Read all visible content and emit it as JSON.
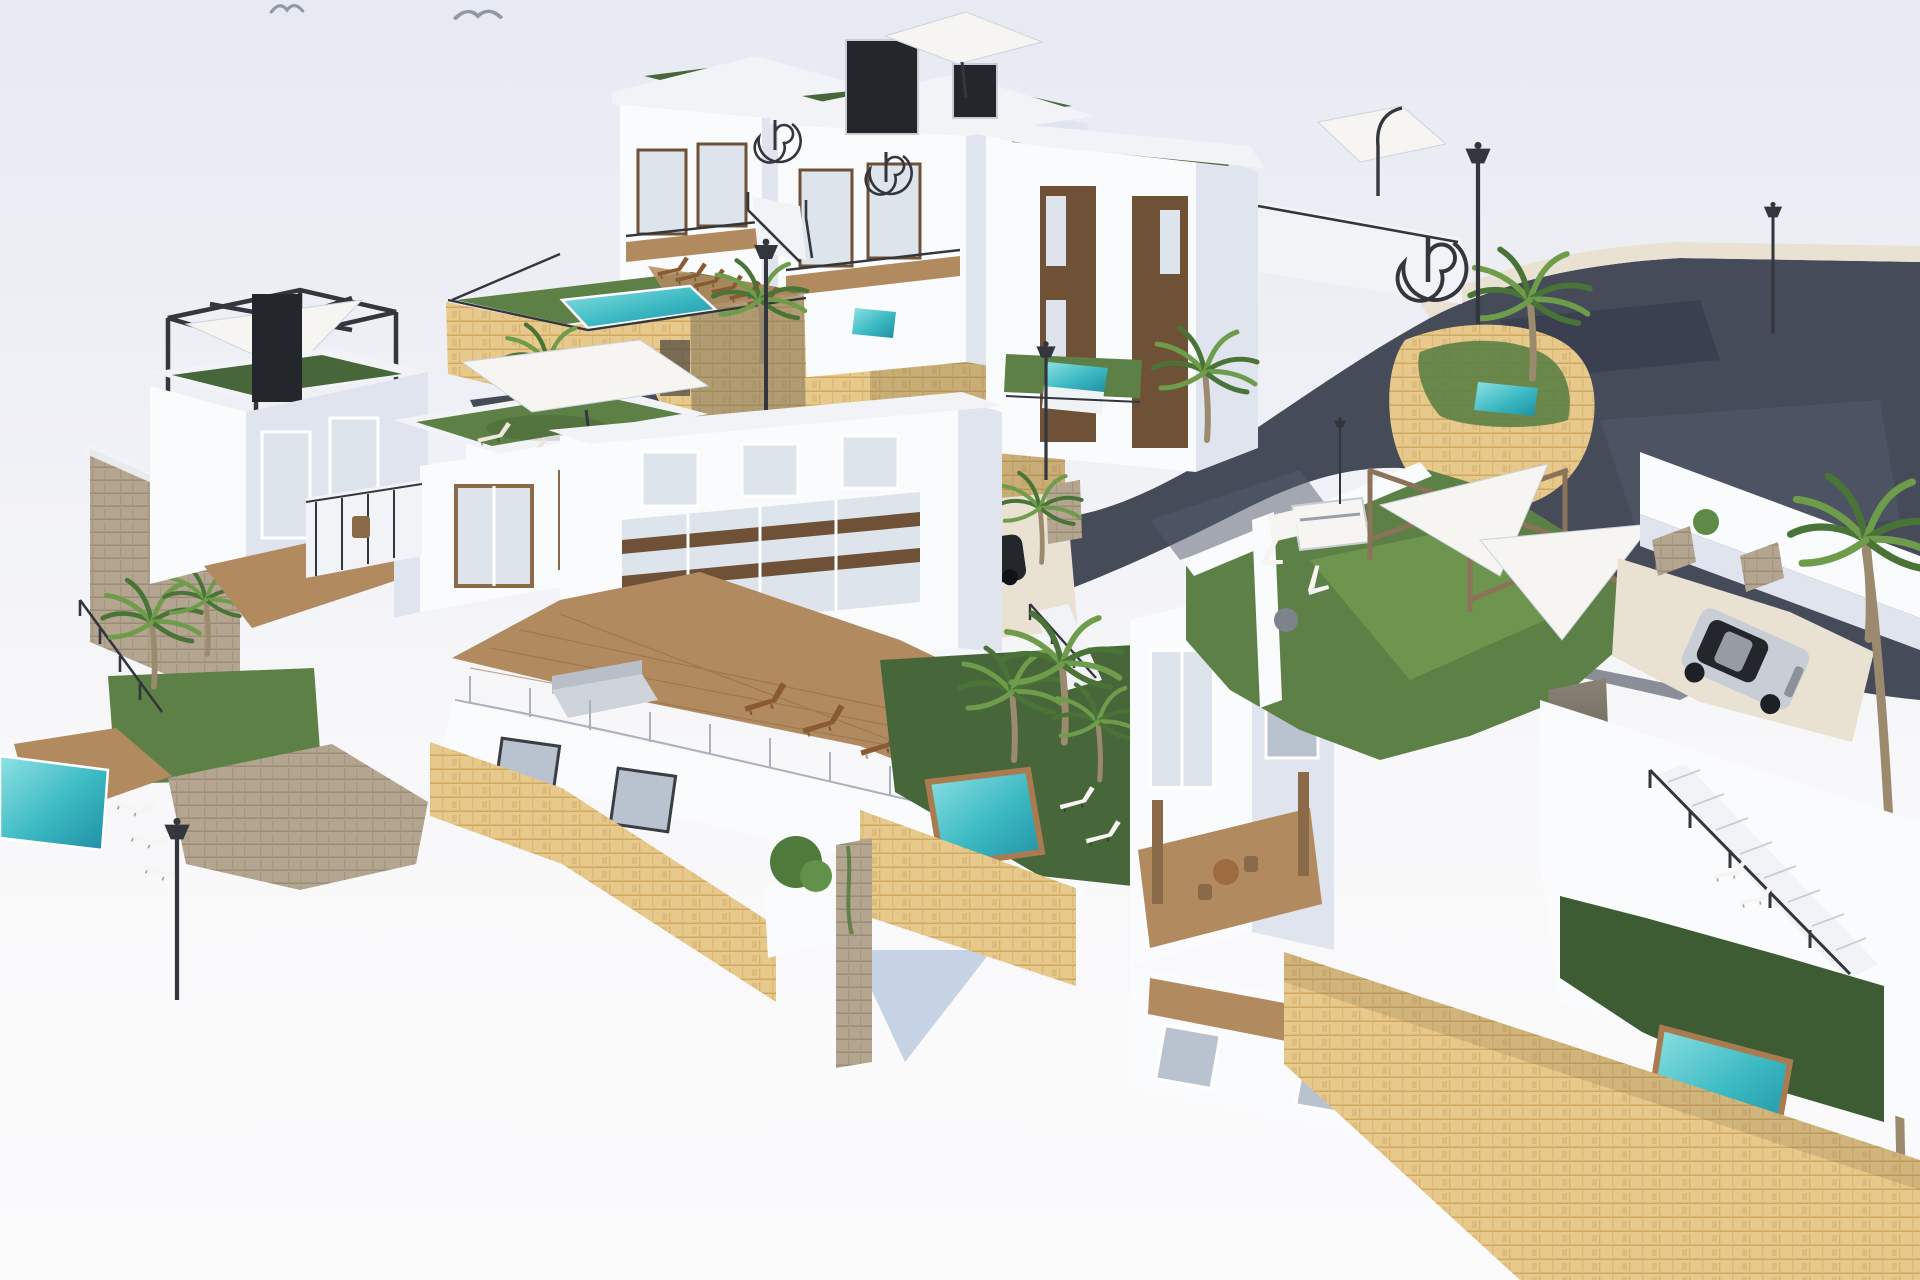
{
  "scene": {
    "type": "3d-architectural-render",
    "view": "aerial-isometric",
    "description": "Aerial 3D architectural rendering of a modern hillside villa development: white multi-storey villas with rooftop lawns and wooden deck terraces, turquoise plunge pools, sandstone retaining walls, palm trees, black street lamps, shade-sail pergolas, spiral staircases, and a curved dark asphalt road with parked cars. Two seagulls fly in the pale sky.",
    "counts": {
      "villas": 9,
      "pools": 7,
      "palm_trees": 10,
      "street_lamps": 6,
      "cars": 5,
      "birds": 2,
      "parasols": 3,
      "shade_sails": 3,
      "spiral_staircases": 4,
      "sun_loungers": 21
    }
  },
  "objects": {
    "cars": [
      {
        "name": "red-hatchback",
        "color": "#d8353f",
        "location": "asphalt road, upper right"
      },
      {
        "name": "dark-red-suv",
        "color": "#a8333c",
        "location": "parking behind centre-left villa"
      },
      {
        "name": "white-coupe",
        "color": "#e8eaee",
        "location": "parking behind centre-left villa"
      },
      {
        "name": "black-sedan",
        "color": "#23262b",
        "location": "patio below retaining wall, centre"
      },
      {
        "name": "silver-hatchback",
        "color": "#c9ced6",
        "location": "driveway, right side"
      }
    ],
    "pools": [
      {
        "name": "community-pool",
        "location": "upper-left terrace"
      },
      {
        "name": "plunge-pool-infinity",
        "location": "below tall villa, centre"
      },
      {
        "name": "small-pool-rear",
        "location": "behind top townhouses"
      },
      {
        "name": "curved-wall-pool",
        "location": "inside curved stone wall by road bend"
      },
      {
        "name": "courtyard-pool",
        "location": "centre courtyard"
      },
      {
        "name": "left-corner-pool",
        "location": "bottom left"
      },
      {
        "name": "right-corner-pool",
        "location": "bottom right lawn"
      }
    ],
    "landscape": [
      "artificial turf roofs",
      "sandstone retaining walls",
      "grey stone garden walls",
      "wooden deck terraces",
      "palm trees",
      "box hedge planter"
    ],
    "furniture": [
      "wooden sun loungers",
      "white sun loungers",
      "cream roof loungers",
      "grey outdoor sofa",
      "round wooden dining table",
      "white bbq station",
      "grey bean-bag pouf",
      "white parasols",
      "white shade sails"
    ]
  },
  "palette": {
    "sky1": "#e7eaf2",
    "sky2": "#f2f3f7",
    "sky3": "#fbfbfc",
    "wall": "#fafbfd",
    "wall2": "#f1f3f7",
    "shade": "#dfe4ee",
    "shade2": "#cbd3e1",
    "stone": "#e8c98c",
    "stoneLine": "#c9a057",
    "stoneDark": "#b89658",
    "stoneG": "#b3a58f",
    "stoneGLine": "#94866f",
    "turfD": "#47663a",
    "turfM": "#5c8045",
    "turfL": "#79a355",
    "pool1": "#7fdde0",
    "pool2": "#2ea7b5",
    "poolDeep": "#1f8fa3",
    "asph": "#454b59",
    "asphD": "#323848",
    "asphL": "#545b6b",
    "walk": "#e9e2d2",
    "deck": "#b18a5f",
    "deckLine": "#916a45",
    "woodD": "#8a5a33",
    "woodL": "#a97a4a",
    "whiteSoft": "#f6f5f1",
    "metal": "#33363c",
    "glass": "#dde4ec",
    "glassD": "#b9c2cf",
    "brown": "#6e5136",
    "brown2": "#8a6a48",
    "carRed": "#d8353f",
    "carRedD": "#a52833",
    "silver": "#c9ced6",
    "dark": "#23262b",
    "cream": "#ece8da",
    "trunk": "#9b8a6e",
    "palmD": "#4a7437",
    "palmL": "#6f9c4b",
    "shadow": "#9fb0c6",
    "blueShade": "#b9c9de"
  }
}
